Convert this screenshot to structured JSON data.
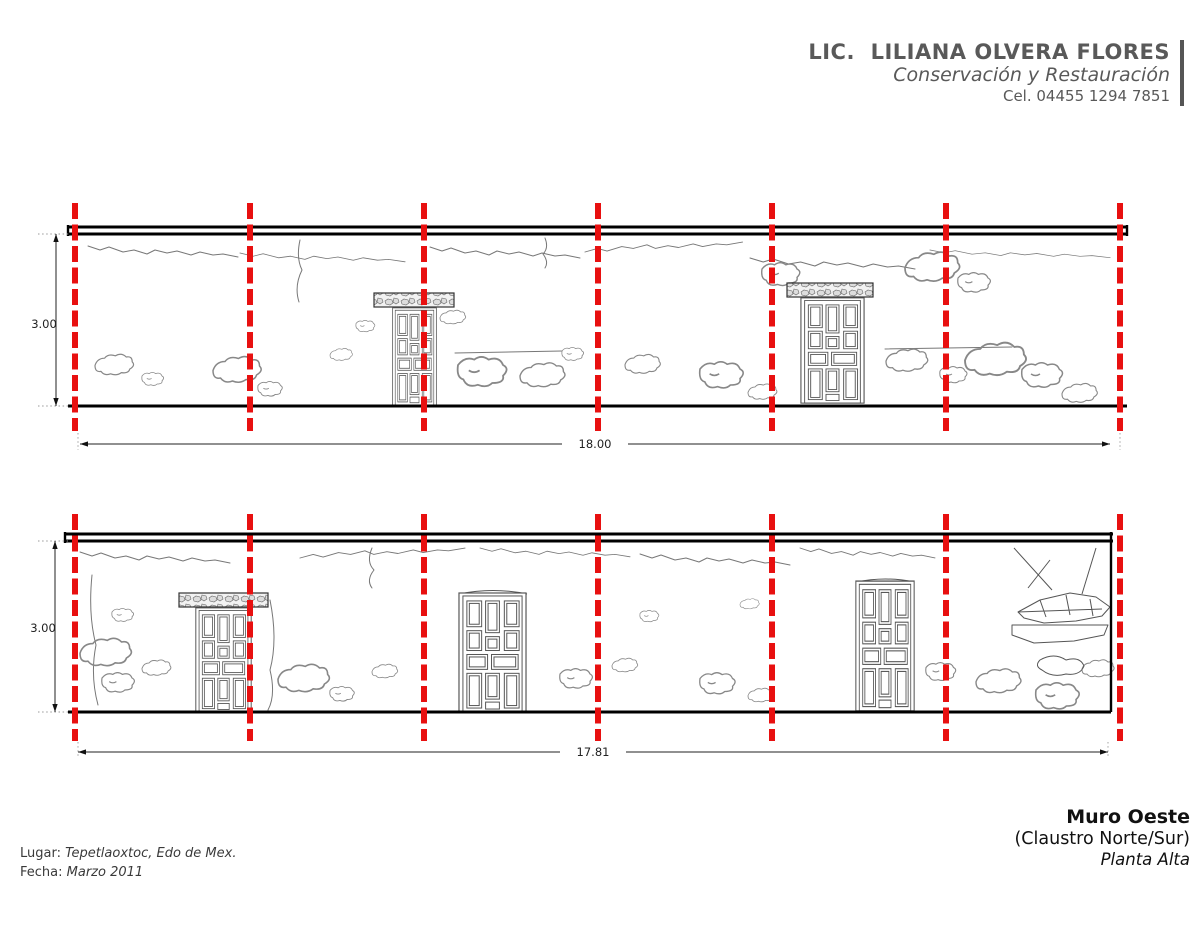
{
  "header": {
    "name": "LIC.  LILIANA OLVERA FLORES",
    "subtitle": "Conservación y Restauración",
    "phone": "Cel. 04455 1294 7851"
  },
  "drawing": {
    "upper": {
      "height_dim": "3.00",
      "width_dim": "18.00",
      "axis_count": 7,
      "doors": 2
    },
    "lower": {
      "height_dim": "3.00",
      "width_dim": "17.81",
      "axis_count": 7,
      "doors": 3
    }
  },
  "footer": {
    "lugar_label": "Lugar:",
    "lugar_value": "Tepetlaoxtoc, Edo de Mex.",
    "fecha_label": "Fecha:",
    "fecha_value": "Marzo 2011"
  },
  "title_block": {
    "title": "Muro Oeste",
    "subtitle": "(Claustro Norte/Sur)",
    "level": "Planta Alta"
  },
  "colors": {
    "axis_red": "#e81010",
    "wall_black": "#000000",
    "header_gray": "#595959"
  }
}
